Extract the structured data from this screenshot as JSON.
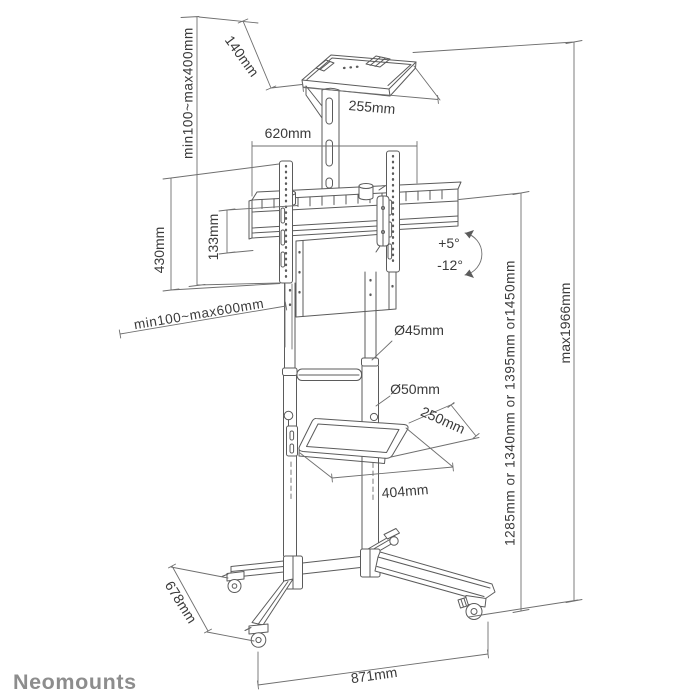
{
  "brand": {
    "logo_text": "Neomounts",
    "logo_color": "#8d8d8d"
  },
  "diagram": {
    "product": "mobile floor stand line drawing",
    "line_color": "#5b5b5b",
    "labels": {
      "camera_shelf_height_range": "min100~max400mm",
      "camera_shelf_depth": "140mm",
      "camera_shelf_width": "255mm",
      "crossbar_width": "620mm",
      "vesa_bracket_height": "430mm",
      "crossbar_profile_height": "133mm",
      "vesa_width_range": "min100~max600mm",
      "tilt_up": "+5°",
      "tilt_down": "-12°",
      "upper_pole_diameter": "Ø45mm",
      "lower_pole_diameter": "Ø50mm",
      "av_shelf_depth": "250mm",
      "av_shelf_width": "404mm",
      "mount_height_options": "1285mm or 1340mm or 1395mm or1450mm",
      "max_height": "max1966mm",
      "base_depth": "678mm",
      "base_width": "871mm"
    }
  }
}
